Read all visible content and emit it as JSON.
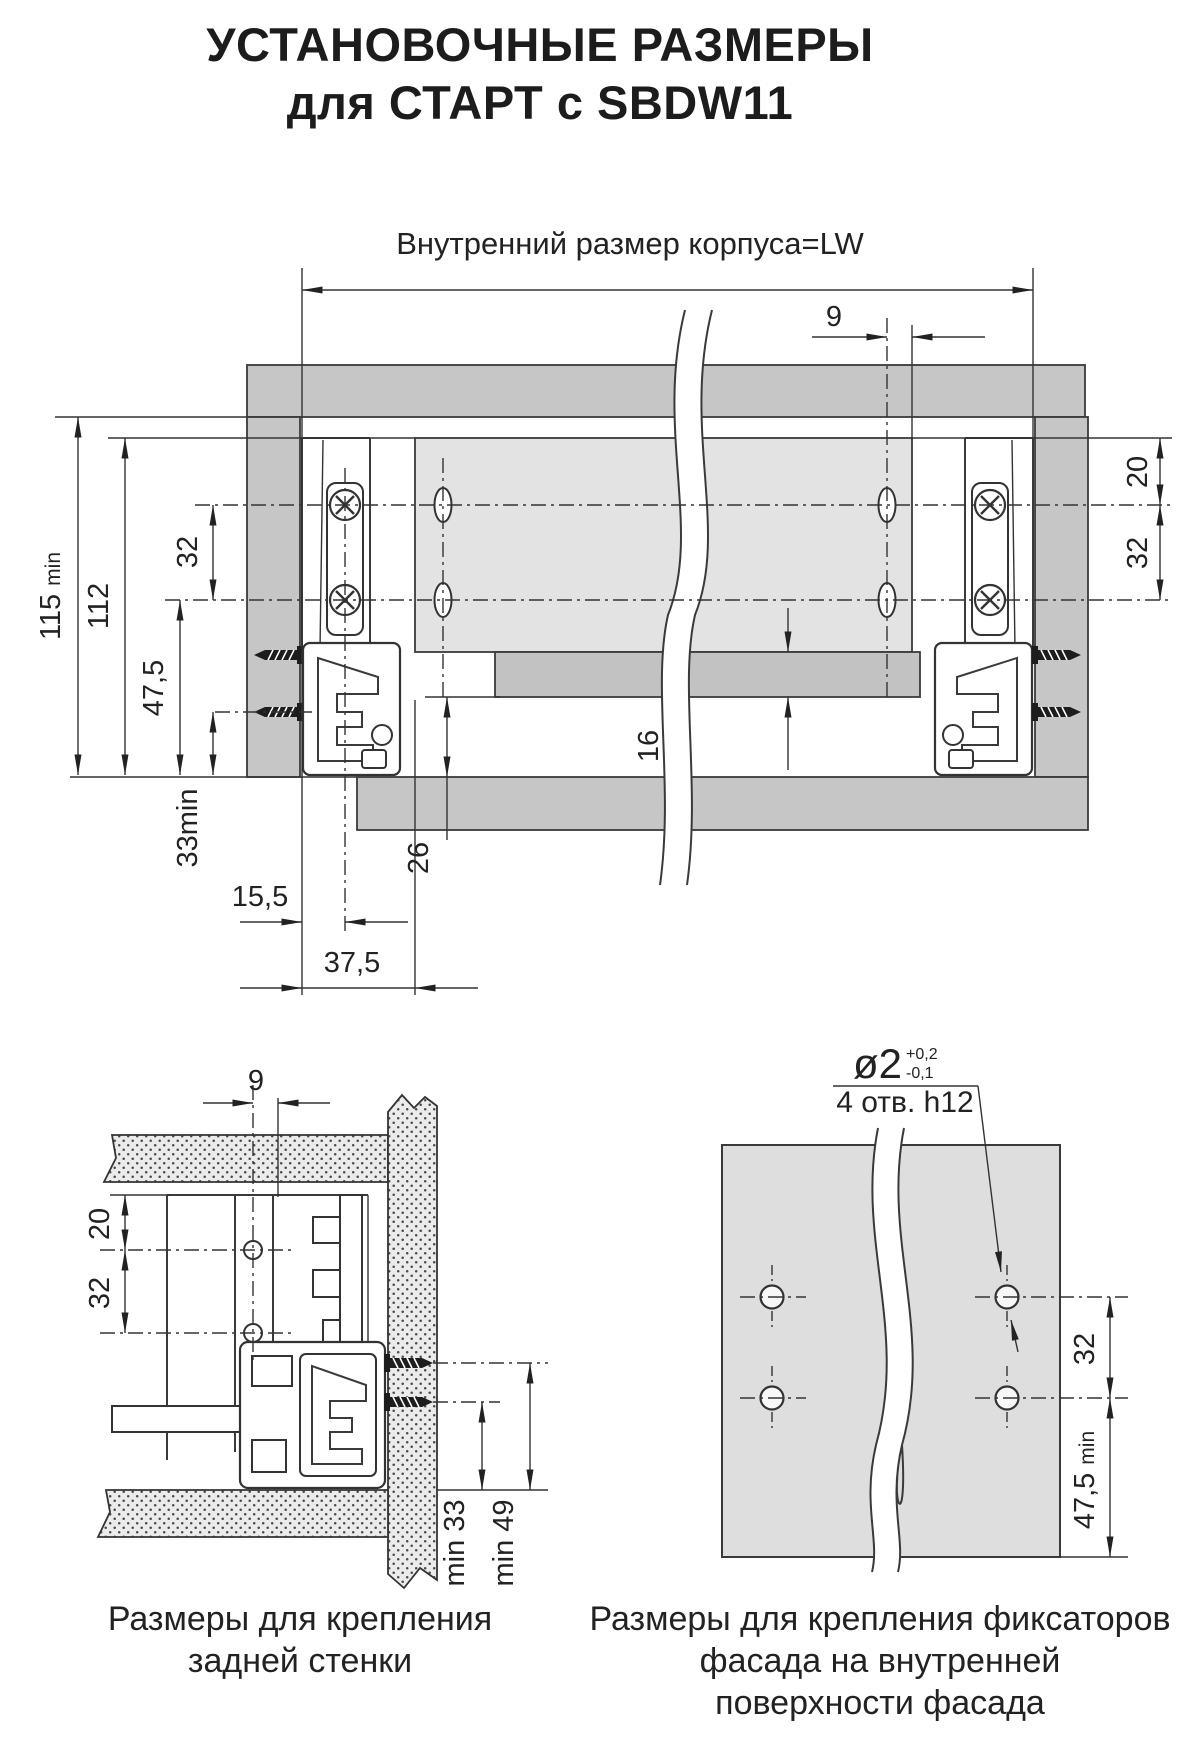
{
  "title": {
    "line1": "УСТАНОВОЧНЫЕ РАЗМЕРЫ",
    "line2": "для СТАРТ с SBDW11"
  },
  "colors": {
    "panel_gray": "#c6c6c6",
    "panel_light": "#e3e3e3",
    "facade_gray": "#dedede",
    "line_dark": "#3a3a3a"
  },
  "main_view": {
    "width_label": "Внутренний размер корпуса=LW",
    "dim_9": "9",
    "dim_115": {
      "value": "115",
      "suffix": "min"
    },
    "dim_112": "112",
    "dim_32_left": "32",
    "dim_47_5": "47,5",
    "dim_33": "33min",
    "dim_15_5": "15,5",
    "dim_37_5": "37,5",
    "dim_26": "26",
    "dim_16": "16",
    "dim_20_right": "20",
    "dim_32_right": "32"
  },
  "back_wall_view": {
    "dim_9": "9",
    "dim_20": "20",
    "dim_32": "32",
    "dim_min33": "min 33",
    "dim_min49": "min 49",
    "caption_line1": "Размеры для крепления",
    "caption_line2": "задней стенки"
  },
  "facade_view": {
    "hole_dia": "ø2",
    "tol_plus": "+0,2",
    "tol_minus": "-0,1",
    "hole_note": "4 отв. h12",
    "dim_32": "32",
    "dim_47_5": {
      "value": "47,5",
      "suffix": "min"
    },
    "caption_line1": "Размеры для крепления фиксаторов",
    "caption_line2": "фасада на внутренней",
    "caption_line3": "поверхности фасада"
  }
}
